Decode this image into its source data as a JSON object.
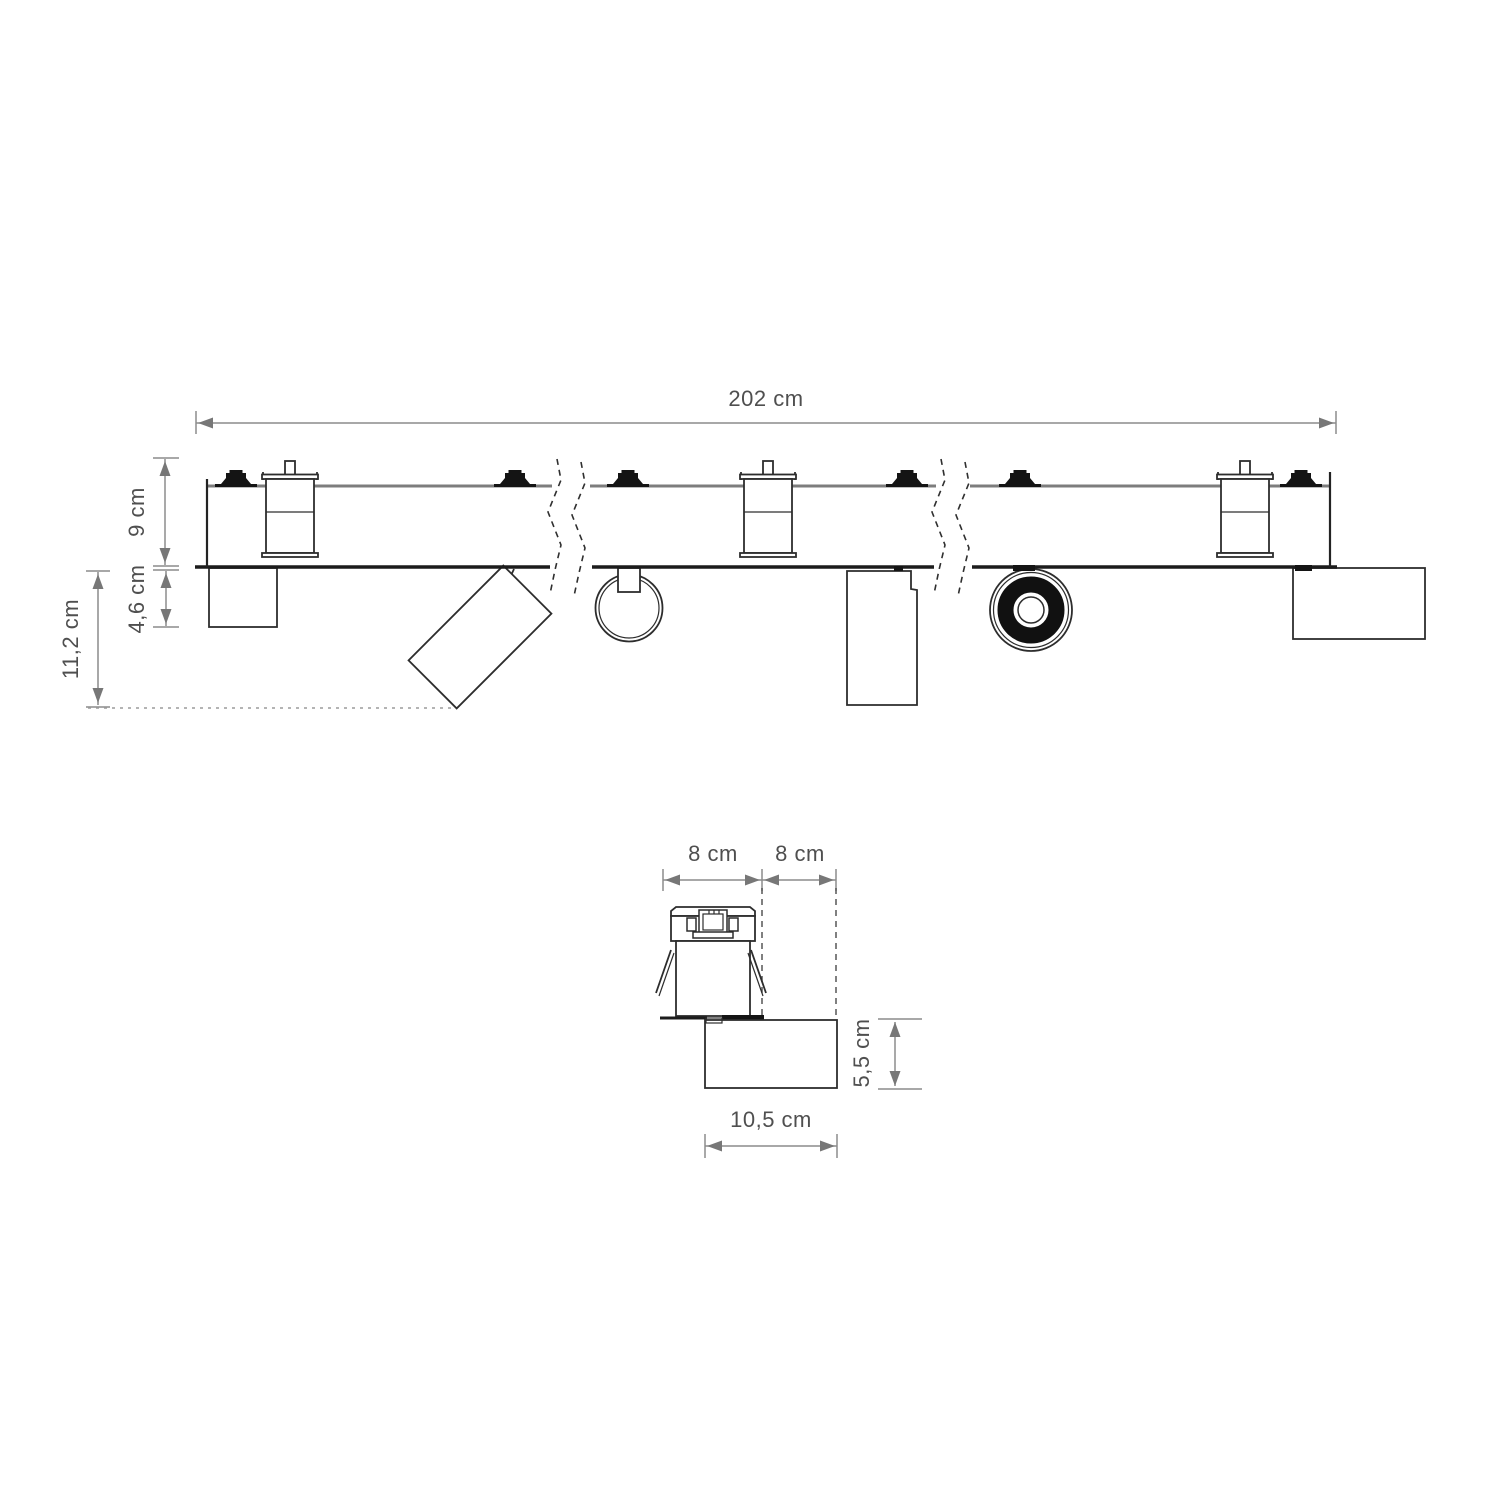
{
  "meta": {
    "drawing_type": "track lighting dimension drawing",
    "background_color": "#ffffff",
    "line_color": "#2d2d2d",
    "dimension_color": "#8c8c8c",
    "text_color": "#4f4f4f"
  },
  "side_view": {
    "length": "202 cm",
    "track_height": "9 cm",
    "fixture_base_depth": "4,6 cm",
    "total_depth": "11,2 cm"
  },
  "detail_view": {
    "recess_width_left": "8 cm",
    "recess_width_right": "8 cm",
    "head_height": "5,5 cm",
    "head_width": "10,5 cm"
  }
}
